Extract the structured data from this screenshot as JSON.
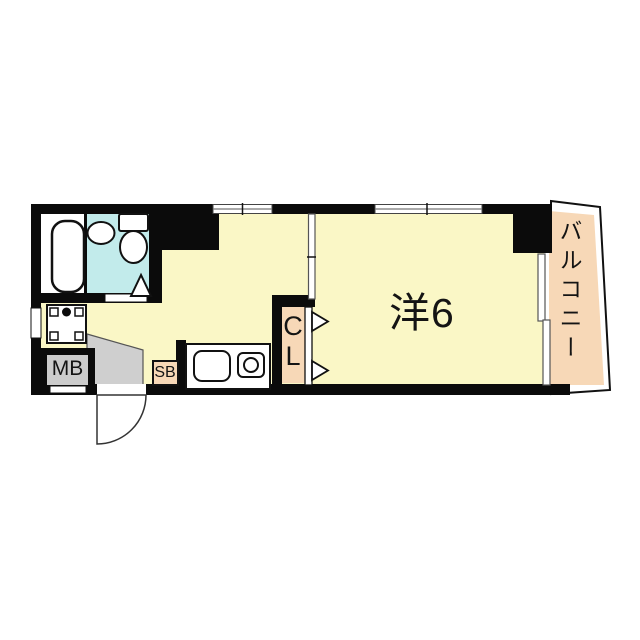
{
  "plan": {
    "labels": {
      "main_room": "洋6",
      "balcony": "バルコニー",
      "closet": "C\nL",
      "shoe_box": "SB",
      "meter_box": "MB"
    },
    "colors": {
      "floor": "#FAF7C6",
      "bath": "#C2EBEB",
      "balcony": "#F7D8B7",
      "closet": "#F7D8B7",
      "shoe_box": "#F7D8B7",
      "entry": "#CFCFCF",
      "meter_box": "#CCCCCC",
      "wall": "#0B0B0B",
      "background": "#FFFFFF"
    },
    "fixtures": [
      {
        "name": "bathtub"
      },
      {
        "name": "wash-basin"
      },
      {
        "name": "toilet"
      },
      {
        "name": "washer-pan"
      },
      {
        "name": "kitchen-sink"
      },
      {
        "name": "gas-stove"
      },
      {
        "name": "entrance-door"
      }
    ]
  }
}
